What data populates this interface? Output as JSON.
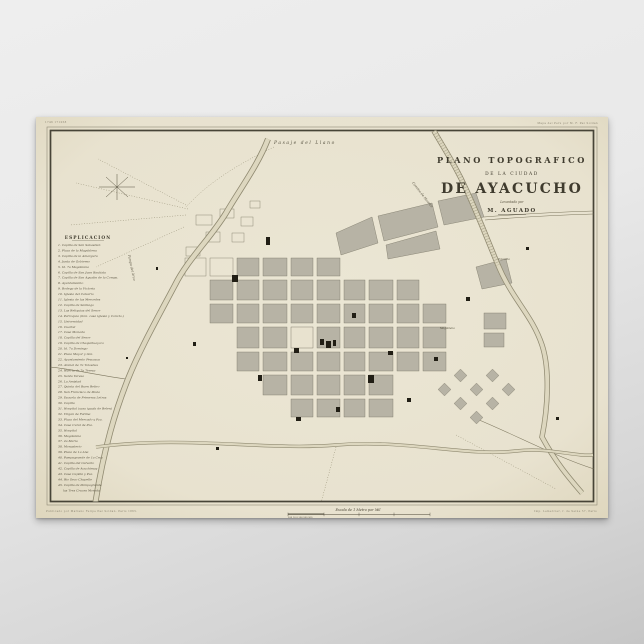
{
  "poster": {
    "margin": {
      "top_left": "1746  171058",
      "top_right": "Mapa del Peru por M. F. Paz Soldan",
      "bottom_left": "Publicado por Mariano Felipe Paz Soldan. Paris 1865.",
      "bottom_right": "Imp. Lemercier, r. de Seine 57, Paris",
      "scale_label": "Escala de 1 Metro por Mil",
      "scale_numbers": "100    50    0        100        200        300"
    }
  },
  "map": {
    "title": {
      "line1": "PLANO TOPOGRAFICO",
      "line2": "DE LA CIUDAD",
      "line3": "DE AYACUCHO",
      "line4": "Levantado por",
      "line5": "M. AGUADO"
    },
    "labels": {
      "pasaje": "Pasaje del Llano",
      "camino": "Camino de Huanta",
      "pampa": "Pampa del Arco",
      "totorilla": "Totorilla",
      "magdalena": "Magdalena"
    },
    "legend": {
      "title": "ESPLICACION",
      "items": [
        "1. Capilla de San Sebastian",
        "2. Plaza de la Magdalena",
        "3. Capilla de la Amargura",
        "4. Junta de Gobierno",
        "5. Id. 7a Magdalena",
        "6. Capilla de San Juan Bautista",
        "7. Capilla de San Agustin de la Compa.",
        "8. Ayuntamiento",
        "9. Bodega de la Victoria",
        "10. Iglesia del Calvario",
        "11. Iglesia de las Mercedes",
        "12. Capilla de Santiago",
        "13. Las Reliquias del Senor",
        "14. Parroquia (ibra. casa iglesia y Convto.)",
        "15. Universidad",
        "16. Cuartel",
        "17. Casa Moneda",
        "18. Capilla del Senor",
        "19. Capilla de Chaquihuaycco",
        "20. Id. 7a Domingo",
        "21. Plaza Mayor y Gra.",
        "22. Ayuntamiento Pescasca",
        "23. Arenal de 7a Tolosbus",
        "24. Huerta de 7a Teresa",
        "25. Santa Teresa",
        "26. La Amistad",
        "27. Quinta del Buen Retiro",
        "28. San Francisco de Paula",
        "29. Escuela de Primeras Letras",
        "30. Capilla",
        "31. Hospital (casa iguala de Belen)",
        "32. Virgen de Fatima",
        "33. Plaza del Mercado y Pza.",
        "34. Casa Cural de Pza.",
        "35. Hospital",
        "36. Magdalena",
        "37. 2a Maria",
        "38. Monasterio",
        "39. Plaza de 1a Ana",
        "40. Pampagrande de 1a Cruz",
        "41. Capilla del Calvario",
        "42. Capilla de Acuchimay",
        "43. Casa Capilla y Pza.",
        "44. Rio Seco Chapelle",
        "45. Capilla de Pampagrande",
        "las Tres Cruces Morada"
      ]
    }
  },
  "colors": {
    "paper": "#e8e2cf",
    "frame": "#474437",
    "block_gray": "#b7b3a5",
    "river_fill": "#ddd7bf",
    "river_edge": "#8f8970",
    "ink": "#3f3b2e",
    "page_background": "#e9e9e9"
  }
}
